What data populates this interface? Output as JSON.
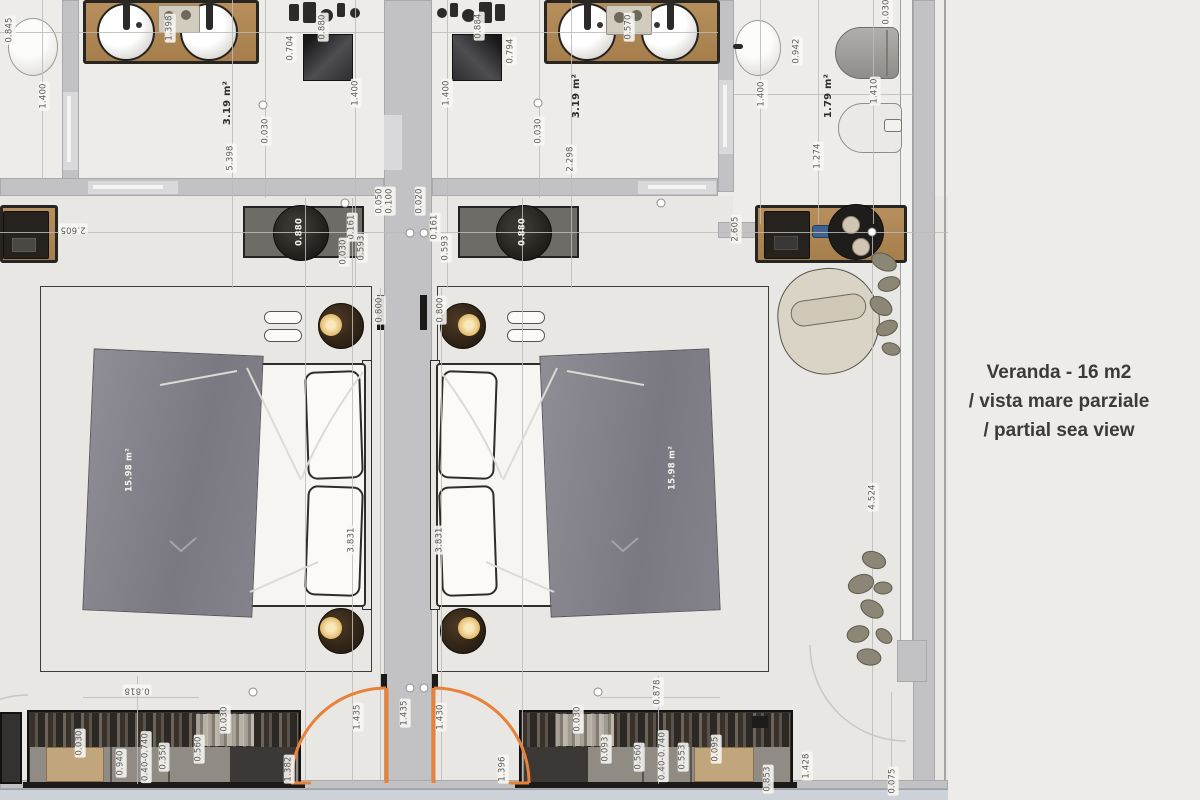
{
  "annotation": {
    "line1": "Veranda - 16 m2",
    "line2": "/ vista mare parziale",
    "line3": "/ partial sea view"
  },
  "colors": {
    "door_accent": "#e8823b",
    "wood": "#b28a58",
    "wall": "#c2c2c4",
    "floor": "#e9e7e4",
    "corridor": "#ccd2d7",
    "bed_runner": "#84828a",
    "lamp_glow": "#e9c87c",
    "note_text": "#3b3b3b"
  },
  "room_areas": [
    "3.19 m²",
    "3.19 m²",
    "1.79 m²",
    "15.98 m²",
    "15.98 m²"
  ],
  "dimension_labels": [
    {
      "text": "0.845",
      "x": 10,
      "y": 30,
      "r": -90,
      "s": "dim"
    },
    {
      "text": "1.400",
      "x": 44,
      "y": 96,
      "r": -90,
      "s": "dim"
    },
    {
      "text": "1.398",
      "x": 170,
      "y": 28,
      "r": -90,
      "s": "dim"
    },
    {
      "text": "0.880",
      "x": 323,
      "y": 27,
      "r": -90,
      "s": "dim"
    },
    {
      "text": "0.704",
      "x": 291,
      "y": 48,
      "r": -90,
      "s": "dim"
    },
    {
      "text": "3.19 m²",
      "x": 228,
      "y": 103,
      "r": -90,
      "s": "area"
    },
    {
      "text": "0.030",
      "x": 266,
      "y": 131,
      "r": -90,
      "s": "dim"
    },
    {
      "text": "5.398",
      "x": 231,
      "y": 158,
      "r": -90,
      "s": "dim"
    },
    {
      "text": "1.400",
      "x": 356,
      "y": 93,
      "r": -90,
      "s": "dim"
    },
    {
      "text": "1.400",
      "x": 447,
      "y": 93,
      "r": -90,
      "s": "dim"
    },
    {
      "text": "0.884",
      "x": 479,
      "y": 26,
      "r": -90,
      "s": "dim"
    },
    {
      "text": "0.794",
      "x": 511,
      "y": 51,
      "r": -90,
      "s": "dim"
    },
    {
      "text": "3.19 m²",
      "x": 577,
      "y": 96,
      "r": -90,
      "s": "area"
    },
    {
      "text": "0.030",
      "x": 539,
      "y": 131,
      "r": -90,
      "s": "dim"
    },
    {
      "text": "2.298",
      "x": 571,
      "y": 159,
      "r": -90,
      "s": "dim"
    },
    {
      "text": "0.570",
      "x": 629,
      "y": 27,
      "r": -90,
      "s": "dim"
    },
    {
      "text": "0.942",
      "x": 797,
      "y": 51,
      "r": -90,
      "s": "dim"
    },
    {
      "text": "1.400",
      "x": 762,
      "y": 94,
      "r": -90,
      "s": "dim"
    },
    {
      "text": "1.79 m²",
      "x": 829,
      "y": 96,
      "r": -90,
      "s": "area"
    },
    {
      "text": "1.410",
      "x": 875,
      "y": 91,
      "r": -90,
      "s": "dim"
    },
    {
      "text": "1.274",
      "x": 818,
      "y": 156,
      "r": -90,
      "s": "dim"
    },
    {
      "text": "0.030",
      "x": 887,
      "y": 12,
      "r": -90,
      "s": "dim"
    },
    {
      "text": "2.605",
      "x": 73,
      "y": 229,
      "r": 180,
      "s": "dim"
    },
    {
      "text": "2.605",
      "x": 736,
      "y": 229,
      "r": -90,
      "s": "dim"
    },
    {
      "text": "0.880",
      "x": 300,
      "y": 232,
      "r": -90,
      "s": "ondark"
    },
    {
      "text": "0.880",
      "x": 523,
      "y": 232,
      "r": -90,
      "s": "ondark"
    },
    {
      "text": "0.161",
      "x": 352,
      "y": 227,
      "r": -90,
      "s": "dim"
    },
    {
      "text": "0.593",
      "x": 362,
      "y": 248,
      "r": -90,
      "s": "dim"
    },
    {
      "text": "0.030",
      "x": 344,
      "y": 252,
      "r": -90,
      "s": "dim"
    },
    {
      "text": "0.050",
      "x": 380,
      "y": 201,
      "r": -90,
      "s": "dim"
    },
    {
      "text": "0.100",
      "x": 390,
      "y": 201,
      "r": -90,
      "s": "dim"
    },
    {
      "text": "0.020",
      "x": 420,
      "y": 201,
      "r": -90,
      "s": "dim"
    },
    {
      "text": "0.161",
      "x": 435,
      "y": 227,
      "r": -90,
      "s": "dim"
    },
    {
      "text": "0.593",
      "x": 446,
      "y": 248,
      "r": -90,
      "s": "dim"
    },
    {
      "text": "0.800",
      "x": 380,
      "y": 310,
      "r": -90,
      "s": "dim"
    },
    {
      "text": "0.800",
      "x": 441,
      "y": 310,
      "r": -90,
      "s": "dim"
    },
    {
      "text": "15.98 m²",
      "x": 130,
      "y": 470,
      "r": -90,
      "s": "ondark"
    },
    {
      "text": "15.98 m²",
      "x": 673,
      "y": 468,
      "r": -90,
      "s": "ondark"
    },
    {
      "text": "3.831",
      "x": 352,
      "y": 540,
      "r": -90,
      "s": "dim"
    },
    {
      "text": "3.831",
      "x": 440,
      "y": 540,
      "r": -90,
      "s": "dim"
    },
    {
      "text": "4.524",
      "x": 873,
      "y": 497,
      "r": -90,
      "s": "dim"
    },
    {
      "text": "0.818",
      "x": 137,
      "y": 690,
      "r": 180,
      "s": "dim"
    },
    {
      "text": "0.878",
      "x": 658,
      "y": 692,
      "r": -90,
      "s": "dim"
    },
    {
      "text": "0.030",
      "x": 80,
      "y": 743,
      "r": -90,
      "s": "dim"
    },
    {
      "text": "0.940",
      "x": 121,
      "y": 763,
      "r": -90,
      "s": "dim"
    },
    {
      "text": "0.40-0.740",
      "x": 146,
      "y": 757,
      "r": -90,
      "s": "dim"
    },
    {
      "text": "0.350",
      "x": 164,
      "y": 757,
      "r": -90,
      "s": "dim"
    },
    {
      "text": "0.560",
      "x": 199,
      "y": 749,
      "r": -90,
      "s": "dim"
    },
    {
      "text": "0.030",
      "x": 225,
      "y": 719,
      "r": -90,
      "s": "dim"
    },
    {
      "text": "1.382",
      "x": 289,
      "y": 769,
      "r": -90,
      "s": "dim"
    },
    {
      "text": "1.435",
      "x": 358,
      "y": 717,
      "r": -90,
      "s": "dim"
    },
    {
      "text": "1.435",
      "x": 405,
      "y": 713,
      "r": -90,
      "s": "dim"
    },
    {
      "text": "1.430",
      "x": 441,
      "y": 717,
      "r": -90,
      "s": "dim"
    },
    {
      "text": "1.396",
      "x": 503,
      "y": 769,
      "r": -90,
      "s": "dim"
    },
    {
      "text": "0.030",
      "x": 578,
      "y": 719,
      "r": -90,
      "s": "dim"
    },
    {
      "text": "0.093",
      "x": 606,
      "y": 749,
      "r": -90,
      "s": "dim"
    },
    {
      "text": "0.560",
      "x": 639,
      "y": 757,
      "r": -90,
      "s": "dim"
    },
    {
      "text": "0.40-0.740",
      "x": 663,
      "y": 756,
      "r": -90,
      "s": "dim"
    },
    {
      "text": "0.553",
      "x": 683,
      "y": 757,
      "r": -90,
      "s": "dim"
    },
    {
      "text": "0.095",
      "x": 716,
      "y": 749,
      "r": -90,
      "s": "dim"
    },
    {
      "text": "0.853",
      "x": 768,
      "y": 779,
      "r": -90,
      "s": "dim"
    },
    {
      "text": "1.428",
      "x": 807,
      "y": 766,
      "r": -90,
      "s": "dim"
    },
    {
      "text": "0.075",
      "x": 893,
      "y": 781,
      "r": -90,
      "s": "dim"
    }
  ]
}
